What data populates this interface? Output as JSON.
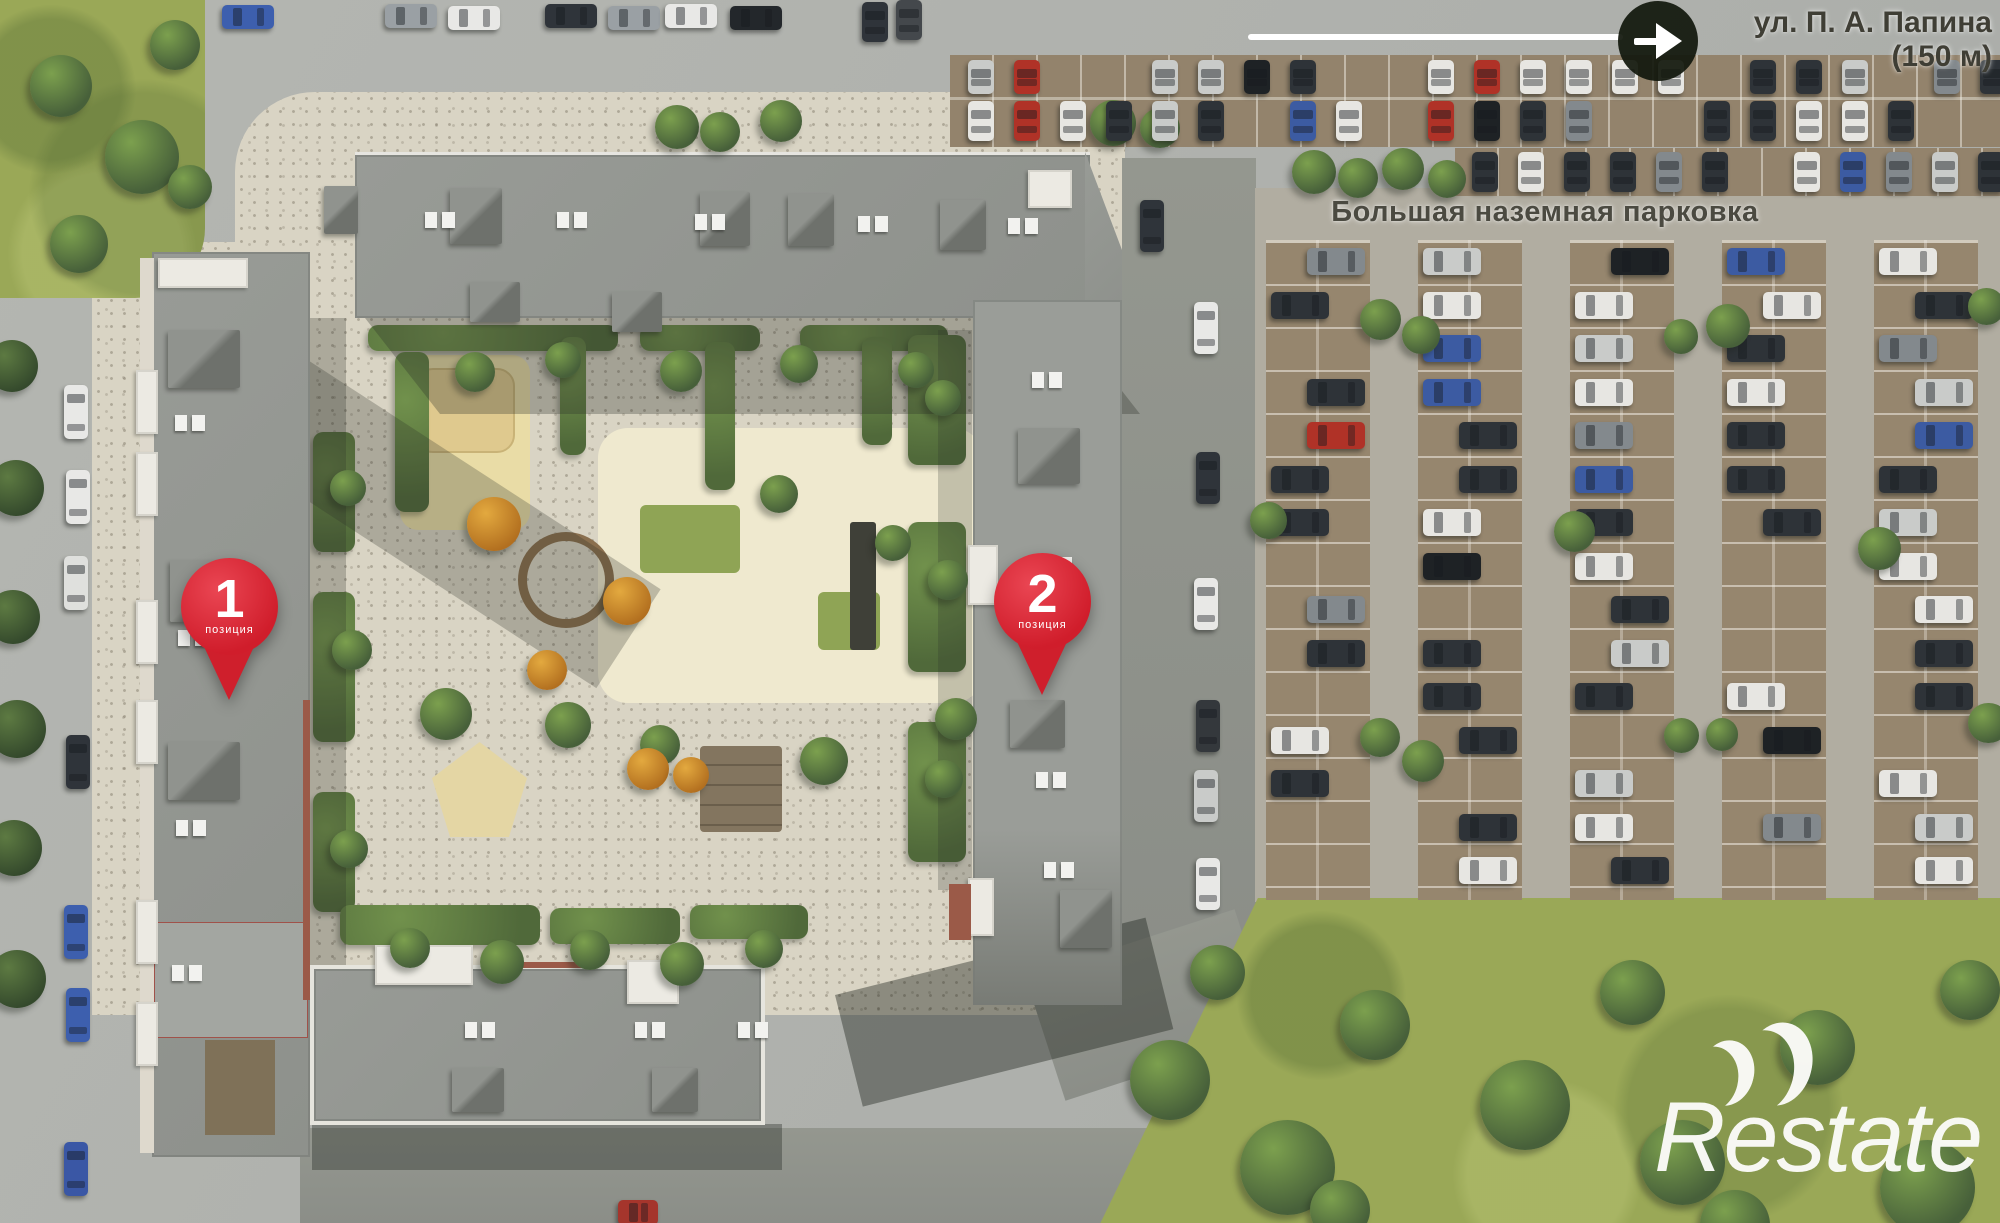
{
  "street_sign": {
    "line1": "ул. П. А. Папина",
    "line2": "(150 м)"
  },
  "parking": {
    "label": "Большая наземная парковка"
  },
  "pins": [
    {
      "number": "1",
      "caption": "позиция"
    },
    {
      "number": "2",
      "caption": "позиция"
    }
  ],
  "watermark": {
    "text": "Restate"
  },
  "colors": {
    "pin_red": "#d01d2b",
    "arrow_circle": "#12180d",
    "label_text": "#4b4a41"
  }
}
